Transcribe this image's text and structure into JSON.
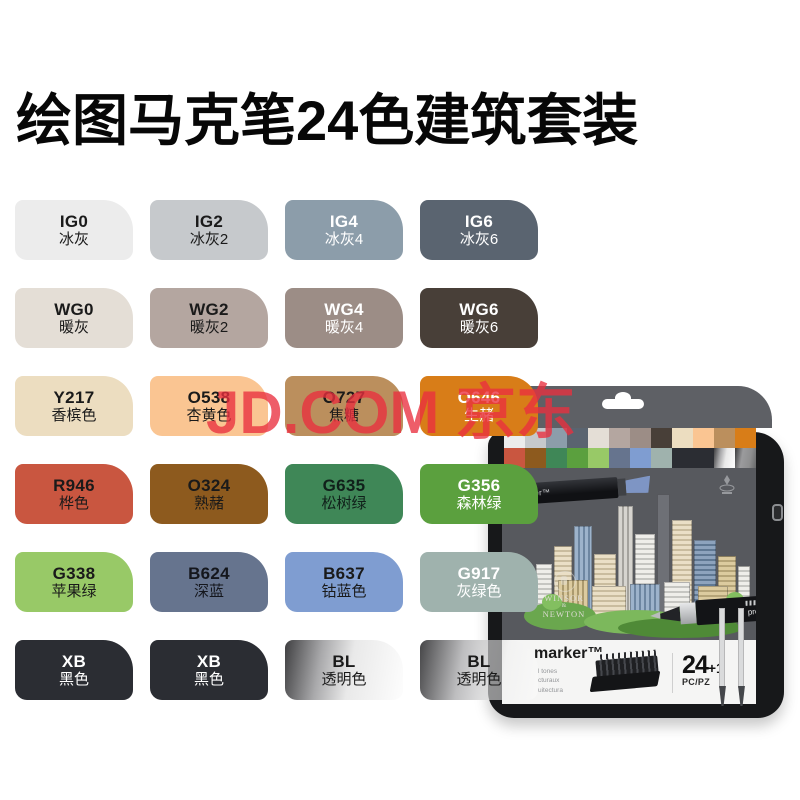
{
  "title": "绘图马克笔24色建筑套装",
  "watermark": "JD.COM 京东",
  "accent_red": "#e9303f",
  "swatches": [
    {
      "code": "IG0",
      "name": "冰灰",
      "bg": "#ececec",
      "fg": "#1a1a1a"
    },
    {
      "code": "IG2",
      "name": "冰灰2",
      "bg": "#c6c9cc",
      "fg": "#1a1a1a"
    },
    {
      "code": "IG4",
      "name": "冰灰4",
      "bg": "#8c9daa",
      "fg": "#ffffff"
    },
    {
      "code": "IG6",
      "name": "冰灰6",
      "bg": "#5a6470",
      "fg": "#ffffff"
    },
    {
      "code": "WG0",
      "name": "暖灰",
      "bg": "#e4ded6",
      "fg": "#1a1a1a"
    },
    {
      "code": "WG2",
      "name": "暖灰2",
      "bg": "#b4a6a0",
      "fg": "#1a1a1a"
    },
    {
      "code": "WG4",
      "name": "暖灰4",
      "bg": "#9c8d86",
      "fg": "#ffffff"
    },
    {
      "code": "WG6",
      "name": "暖灰6",
      "bg": "#483f38",
      "fg": "#ffffff"
    },
    {
      "code": "Y217",
      "name": "香槟色",
      "bg": "#ecddc0",
      "fg": "#1a1a1a"
    },
    {
      "code": "O538",
      "name": "杏黄色",
      "bg": "#fac592",
      "fg": "#1a1a1a"
    },
    {
      "code": "O727",
      "name": "焦糖",
      "bg": "#bb8f5d",
      "fg": "#1a1a1a"
    },
    {
      "code": "O646",
      "name": "生赭",
      "bg": "#d87d18",
      "fg": "#ffffff"
    },
    {
      "code": "R946",
      "name": "桦色",
      "bg": "#c95640",
      "fg": "#1a1a1a"
    },
    {
      "code": "O324",
      "name": "熟赭",
      "bg": "#8d5a1e",
      "fg": "#1a1a1a"
    },
    {
      "code": "G635",
      "name": "松树绿",
      "bg": "#3f8757",
      "fg": "#10201a"
    },
    {
      "code": "G356",
      "name": "森林绿",
      "bg": "#5ba03e",
      "fg": "#ffffff"
    },
    {
      "code": "G338",
      "name": "苹果绿",
      "bg": "#98c967",
      "fg": "#1a1a1a"
    },
    {
      "code": "B624",
      "name": "深蓝",
      "bg": "#66748e",
      "fg": "#14161c"
    },
    {
      "code": "B637",
      "name": "钴蓝色",
      "bg": "#7f9dd1",
      "fg": "#1a1a1a"
    },
    {
      "code": "G917",
      "name": "灰绿色",
      "bg": "#9fb2ad",
      "fg": "#ffffff"
    },
    {
      "code": "XB",
      "name": "黑色",
      "bg": "#2b2d33",
      "fg": "#ffffff"
    },
    {
      "code": "XB",
      "name": "黑色",
      "bg": "#2b2d33",
      "fg": "#ffffff"
    },
    {
      "code": "BL",
      "name": "透明色",
      "bg": "linear-gradient(100deg,#3f3f41 0%,#a9a9ab 30%,#e9e9e9 55%,#fdfdfd 100%)",
      "fg": "#1a1a1a"
    },
    {
      "code": "BL",
      "name": "透明色",
      "bg": "linear-gradient(100deg,rgba(60,60,62,0.95) 0%,rgba(178,178,180,0.85) 35%,rgba(240,240,240,0.55) 70%,rgba(255,255,255,0.35) 100%)",
      "fg": "#1a1a1a"
    }
  ],
  "product": {
    "black_marker_label": "ker™",
    "silver_marker_label": "promark",
    "brand_lines": [
      "WINSOR",
      "&",
      "NEWTON"
    ],
    "strip": {
      "logo": "marker™",
      "desc_lines": [
        "l tones",
        "cturaux",
        "uitectura"
      ],
      "count": "24",
      "count_suffix": "+1",
      "unit": "PC/PZ"
    }
  }
}
